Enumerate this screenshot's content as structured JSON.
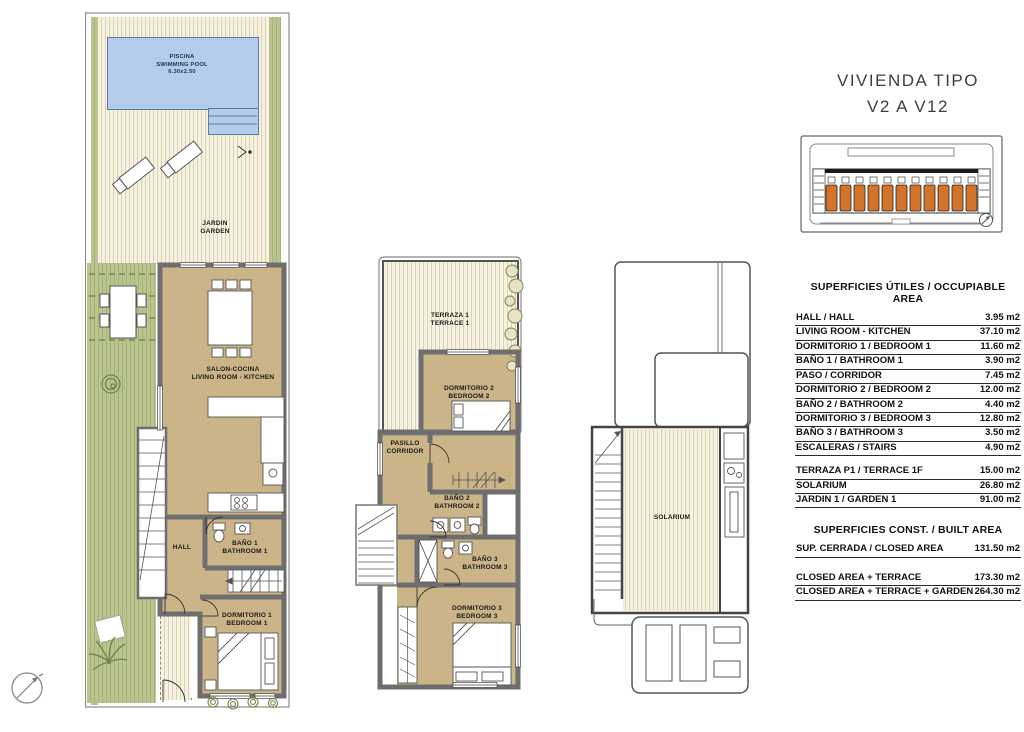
{
  "title": {
    "line1": "VIVIENDA TIPO",
    "line2": "V2 A V12"
  },
  "ground_floor": {
    "pool_name": "PISCINA",
    "pool_name_en": "SWIMMING POOL",
    "pool_size": "6.30x2.50",
    "garden_name": "JARDIN",
    "garden_name_en": "GARDEN",
    "living_name": "SALON-COCINA",
    "living_name_en": "LIVING ROOM - KITCHEN",
    "hall_name": "HALL",
    "bath1_name": "BAÑO 1",
    "bath1_name_en": "BATHROOM 1",
    "bed1_name": "DORMITORIO 1",
    "bed1_name_en": "BEDROOM 1"
  },
  "first_floor": {
    "terrace_name": "TERRAZA 1",
    "terrace_name_en": "TERRACE 1",
    "bed2_name": "DORMITORIO 2",
    "bed2_name_en": "BEDROOM 2",
    "corridor_name": "PASILLO",
    "corridor_name_en": "CORRIDOR",
    "bath2_name": "BAÑO 2",
    "bath2_name_en": "BATHROOM 2",
    "bath3_name": "BAÑO 3",
    "bath3_name_en": "BATHROOM 3",
    "bed3_name": "DORMITORIO 3",
    "bed3_name_en": "BEDROOM 3"
  },
  "roof_floor": {
    "solarium_name": "SOLARIUM"
  },
  "site_key": {
    "units_highlighted": 11
  },
  "areas_useful": {
    "header": "SUPERFICIES ÚTILES / OCCUPIABLE AREA",
    "rows": [
      {
        "label": "HALL / HALL",
        "value": "3.95 m2"
      },
      {
        "label": "LIVING ROOM - KITCHEN",
        "value": "37.10 m2"
      },
      {
        "label": "DORMITORIO 1 / BEDROOM 1",
        "value": "11.60 m2"
      },
      {
        "label": "BAÑO 1 / BATHROOM 1",
        "value": "3.90 m2"
      },
      {
        "label": "PASO / CORRIDOR",
        "value": "7.45 m2"
      },
      {
        "label": "DORMITORIO 2 / BEDROOM 2",
        "value": "12.00 m2"
      },
      {
        "label": "BAÑO 2 / BATHROOM 2",
        "value": "4.40 m2"
      },
      {
        "label": "DORMITORIO 3 / BEDROOM 3",
        "value": "12.80 m2"
      },
      {
        "label": "BAÑO 3 / BATHROOM 3",
        "value": "3.50 m2"
      },
      {
        "label": "ESCALERAS / STAIRS",
        "value": "4.90 m2"
      }
    ],
    "outdoor_rows": [
      {
        "label": "TERRAZA P1 / TERRACE 1F",
        "value": "15.00 m2"
      },
      {
        "label": "SOLARIUM",
        "value": "26.80 m2"
      },
      {
        "label": "JARDIN 1 / GARDEN 1",
        "value": "91.00 m2"
      }
    ]
  },
  "areas_built": {
    "header": "SUPERFICIES CONST. / BUILT AREA",
    "closed_rows": [
      {
        "label": "SUP. CERRADA / CLOSED AREA",
        "value": "131.50 m2"
      }
    ],
    "total_rows": [
      {
        "label": "CLOSED AREA + TERRACE",
        "value": "173.30 m2"
      },
      {
        "label": "CLOSED AREA + TERRACE + GARDEN",
        "value": "264.30 m2"
      }
    ]
  },
  "colors": {
    "pool_blue": "#b4cdea",
    "interior_tan": "#cbb488",
    "garden_green": "#b9c48e",
    "deck_cream": "#f6f1e1",
    "highlight_orange": "#d4732a"
  }
}
